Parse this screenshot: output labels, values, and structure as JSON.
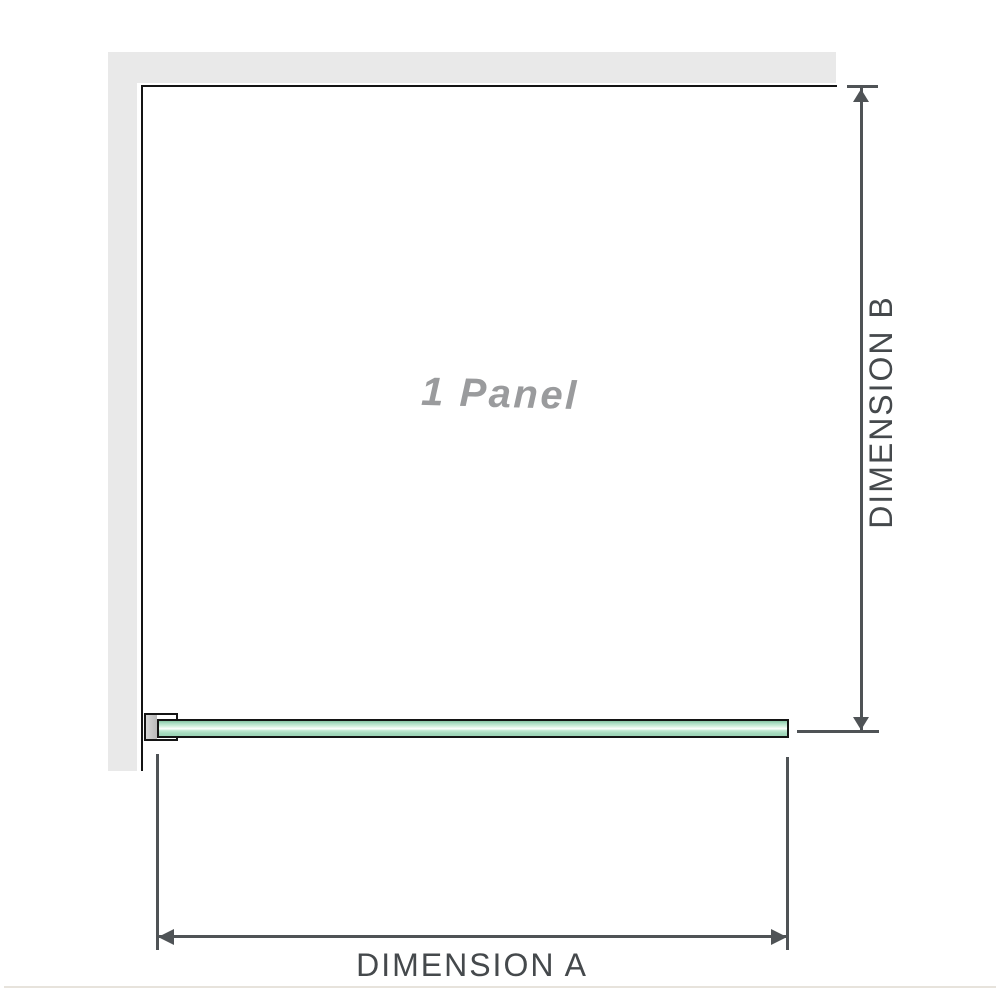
{
  "diagram": {
    "title": "1 Panel",
    "dimensions": {
      "a_label": "DIMENSION A",
      "b_label": "DIMENSION B"
    }
  },
  "colors": {
    "wall": "#e9e9e9",
    "outline": "#141414",
    "dimension": "#4f5356",
    "dimension_text": "#45494c",
    "label_gray": "#9a9b9d",
    "glass_top": "#85c4a3",
    "glass_light": "#eef9f2",
    "glass_mid": "#a5dabd",
    "bracket_fill": "#d6d6d6",
    "divider": "#e7e3dc"
  }
}
